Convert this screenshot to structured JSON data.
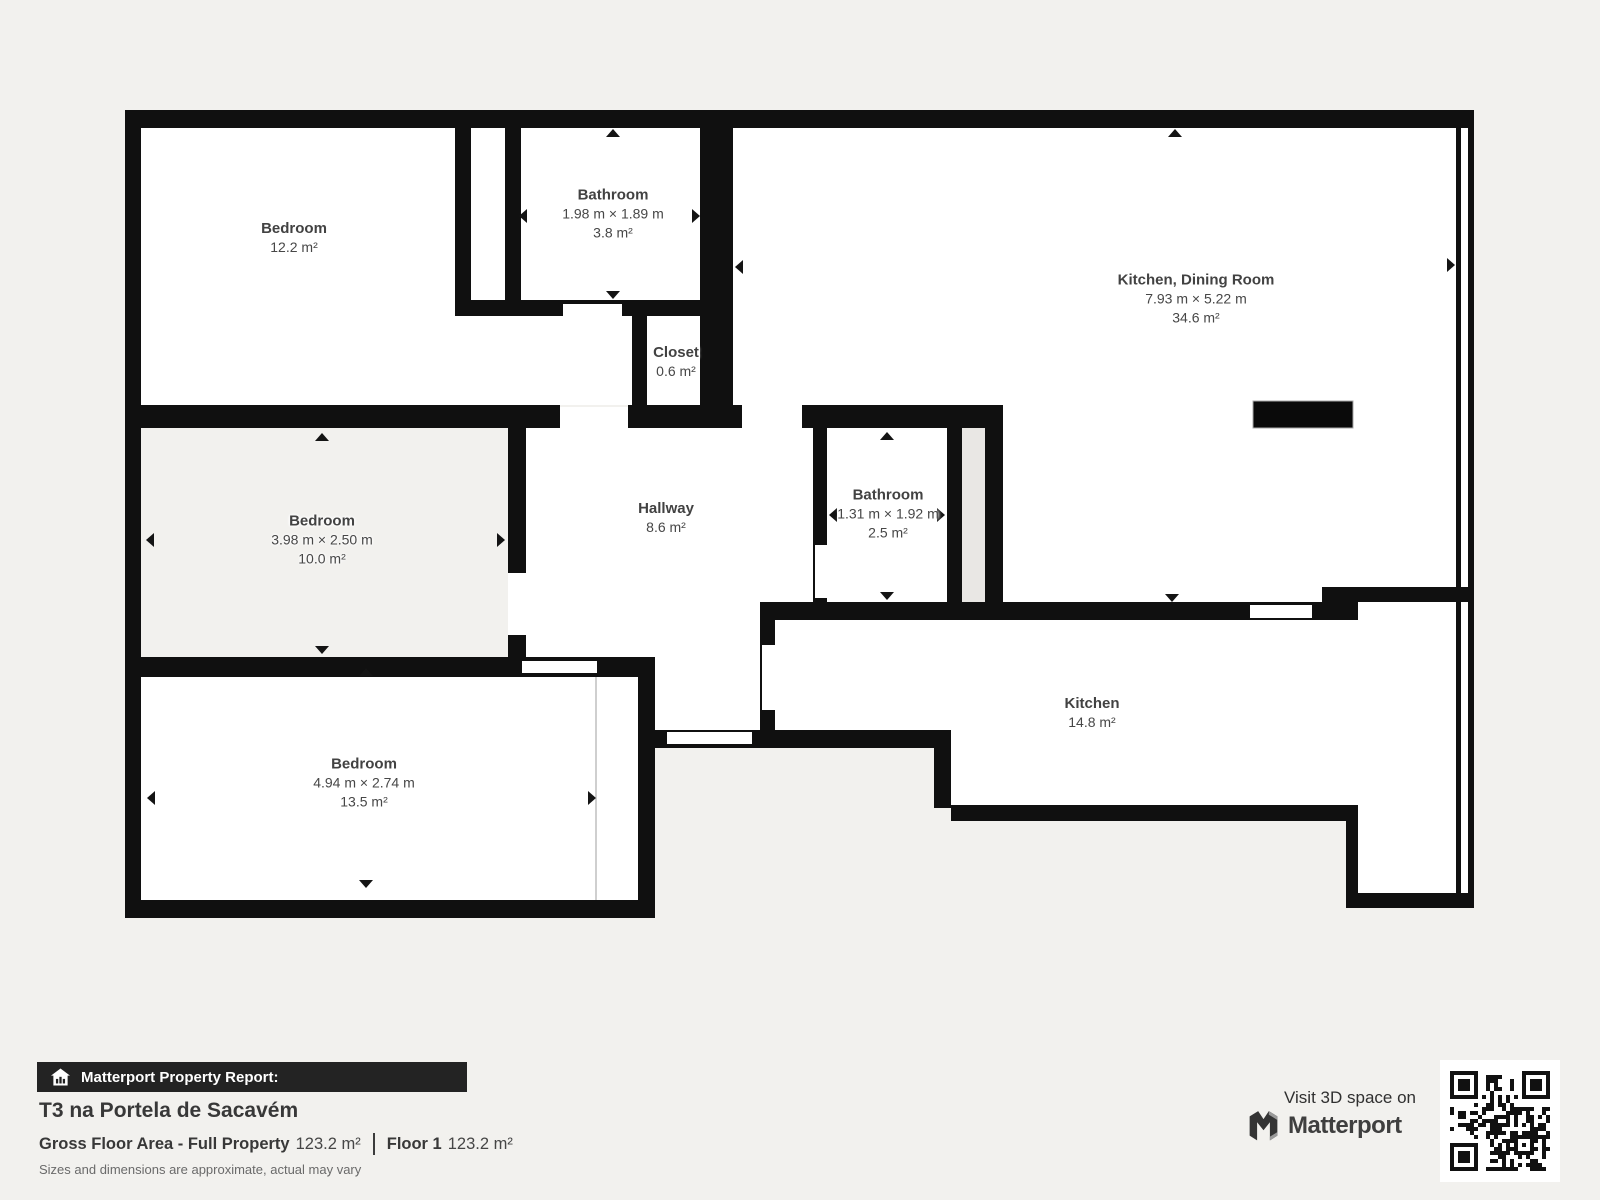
{
  "plan": {
    "rooms": [
      {
        "id": "bedroom-top-left",
        "name": "Bedroom",
        "area": "12.2 m²"
      },
      {
        "id": "bathroom-top",
        "name": "Bathroom",
        "dims": "1.98 m × 1.89 m",
        "area": "3.8 m²"
      },
      {
        "id": "kitchen-dining-room",
        "name": "Kitchen, Dining Room",
        "dims": "7.93 m × 5.22 m",
        "area": "34.6 m²"
      },
      {
        "id": "closet",
        "name": "Closet",
        "area": "0.6 m²"
      },
      {
        "id": "bedroom-middle",
        "name": "Bedroom",
        "dims": "3.98 m × 2.50 m",
        "area": "10.0 m²"
      },
      {
        "id": "hallway",
        "name": "Hallway",
        "area": "8.6 m²"
      },
      {
        "id": "bathroom-middle",
        "name": "Bathroom",
        "dims": "1.31 m × 1.92 m",
        "area": "2.5 m²"
      },
      {
        "id": "kitchen",
        "name": "Kitchen",
        "area": "14.8 m²"
      },
      {
        "id": "bedroom-bottom",
        "name": "Bedroom",
        "dims": "4.94 m × 2.74 m",
        "area": "13.5 m²"
      }
    ]
  },
  "report": {
    "badge": "Matterport Property Report:",
    "property_title": "T3 na Portela de Sacavém",
    "gross_label": "Gross Floor Area - Full Property",
    "gross_value": "123.2 m²",
    "floor_label": "Floor 1",
    "floor_value": "123.2 m²",
    "disclaimer": "Sizes and dimensions are approximate, actual may vary"
  },
  "branding": {
    "visit_text": "Visit 3D space on",
    "brand_name": "Matterport"
  },
  "icons": {
    "house_icon": "house-with-chart-bars",
    "qr_code": "qr-code",
    "dimension_arrows": "black triangle markers at room wall midpoints"
  },
  "colors": {
    "background": "#f2f1ee",
    "wall": "#101010",
    "room_fill": "#ffffff",
    "shaft_fill": "#e9e7e4",
    "badge_bar": "#232323",
    "label_text": "#424242"
  }
}
